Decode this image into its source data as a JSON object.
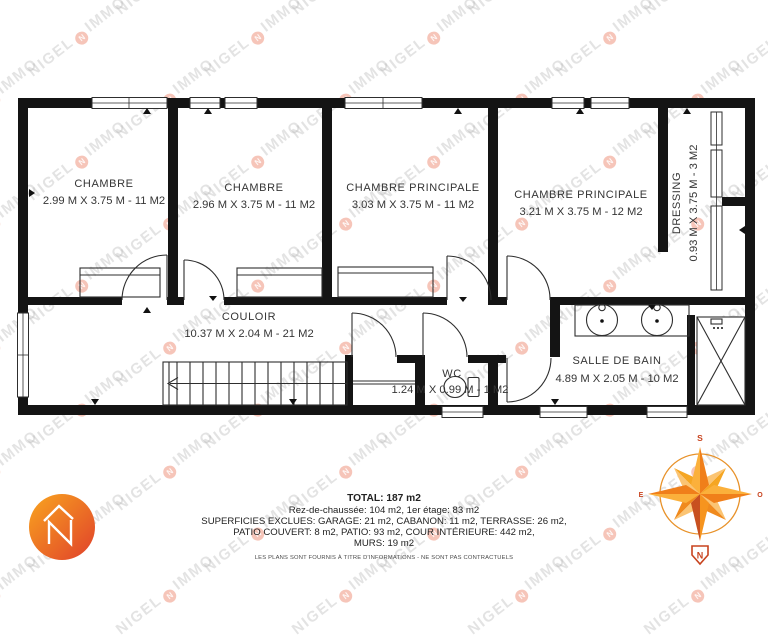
{
  "watermark": {
    "word1": "NIGEL",
    "word2": "IMMO",
    "dot_letter": "N"
  },
  "plan": {
    "rooms": [
      {
        "name": "CHAMBRE",
        "dims": "2.99 M X 3.75 M - 11 M2"
      },
      {
        "name": "CHAMBRE",
        "dims": "2.96 M X 3.75 M - 11 M2"
      },
      {
        "name": "CHAMBRE PRINCIPALE",
        "dims": "3.03 M X 3.75 M - 11 M2"
      },
      {
        "name": "CHAMBRE PRINCIPALE",
        "dims": "3.21 M X 3.75 M - 12 M2"
      },
      {
        "name": "DRESSING",
        "dims": "0.93 M X 3.75 M - 3 M2"
      },
      {
        "name": "COULOIR",
        "dims": "10.37 M X 2.04 M - 21 M2"
      },
      {
        "name": "WC",
        "dims": "1.24 M X 0.99 M - 1 M2"
      },
      {
        "name": "SALLE DE BAIN",
        "dims": "4.89 M X 2.05 M - 10 M2"
      }
    ]
  },
  "compass": {
    "top": "S",
    "bottom": "N",
    "left": "E",
    "right": "O"
  },
  "summary": {
    "total": "TOTAL: 187 m2",
    "floors": "Rez-de-chaussée: 104 m2, 1er étage: 83 m2",
    "excluded1": "SUPERFICIES EXCLUES: GARAGE: 21 m2, CABANON: 11 m2, TERRASSE: 26 m2,",
    "excluded2": "PATIO COUVERT: 8 m2, PATIO: 93 m2, COUR INTÉRIEURE: 442 m2,",
    "excluded3": "MURS: 19 m2",
    "disclaimer": "LES PLANS SONT FOURNIS À TITRE D'INFORMATIONS - NE SONT PAS CONTRACTUELS"
  },
  "colors": {
    "wall": "#141414",
    "accent_light": "#FBB03B",
    "accent_mid": "#F07F1A",
    "accent_deep": "#C85020",
    "watermark_text": "#acacac",
    "watermark_dot": "#ea7458"
  }
}
